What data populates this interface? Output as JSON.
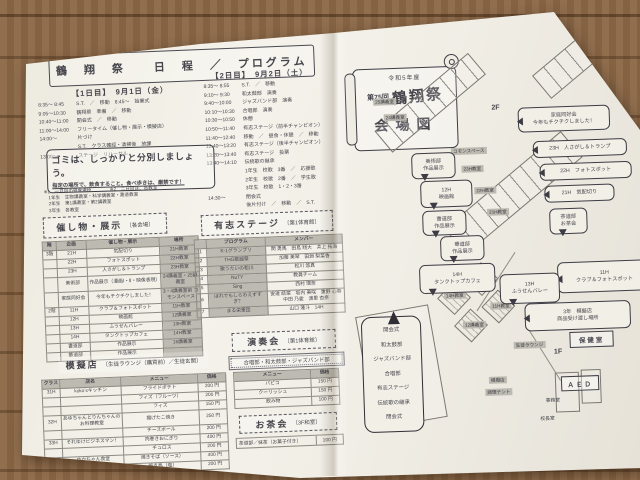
{
  "left_page": {
    "title": "鶴　翔　祭　　日　程　／　プログラム",
    "day1": {
      "heading": "【1日目】　9月1日（金）",
      "rows": [
        {
          "time": "8:35～ 8:45",
          "text": "S.T.　／　移動　8:45～　始業式"
        },
        {
          "time": "9:05～10:30",
          "text": "鶴翔祭　準備　／　移動"
        },
        {
          "time": "10:40～11:00",
          "text": "開会式　／　移動"
        },
        {
          "time": "11:00～14:00",
          "text": "フリータイム（催し物・展示・模擬店）"
        },
        {
          "time": "14:00～",
          "text": "片づけ"
        },
        {
          "time": "",
          "text": "S.T.　クラス確認・清掃後　放課"
        },
        {
          "time": "13:00～",
          "text": "ステージ　リハーサル"
        }
      ]
    },
    "day2": {
      "heading": "【2日目】　9月2日（土）",
      "rows": [
        {
          "time": "8:35～ 8:55",
          "text": "S.T.　／　移動"
        },
        {
          "time": "9:10～ 9:30",
          "text": "和太鼓部　演奏"
        },
        {
          "time": "9:40～10:00",
          "text": "ジャズバンド部　演奏"
        },
        {
          "time": "10:10～10:30",
          "text": "合唱部　演奏"
        },
        {
          "time": "10:30～10:50",
          "text": "休憩"
        },
        {
          "time": "10:50～11:40",
          "text": "有志ステージ（前半チャンピオン）"
        },
        {
          "time": "11:40～12:40",
          "text": "移動　／　昼食・休憩　／　移動"
        },
        {
          "time": "12:40～13:20",
          "text": "有志ステージ（後半チャンピオン）"
        },
        {
          "time": "13:20～13:40",
          "text": "有志ステージ　投票"
        },
        {
          "time": "13:40～14:10",
          "text": "伝統歌の継承"
        },
        {
          "time": "",
          "text": "1年生　校歌　3番　／　応援歌"
        },
        {
          "time": "",
          "text": "2年生　校歌　2番　／　学生歌"
        },
        {
          "time": "",
          "text": "3年生　校歌　1・2・3番"
        },
        {
          "time": "14:30～",
          "text": "閉会式"
        },
        {
          "time": "",
          "text": "後片付け　／　移動　／　S.T."
        }
      ]
    },
    "notice": {
      "line1": "ゴミは、しっかりと分別しましょう。",
      "line2": "指定の場所で、飲食すること。食べ歩きは、厳禁です！"
    },
    "footnotes": [
      "※1　一日目の昼食場所　　　　※2　二日目は、各教室",
      "　1年生　生物講義室・科学講義室・書道教室",
      "　2年生　第1講義室・第2講義室",
      "　3年生　各教室"
    ],
    "events": {
      "title": "催し物・展示",
      "venue": "〔各会場〕",
      "columns": [
        "階",
        "企画",
        "催し物・展示",
        "場所"
      ],
      "rows": [
        {
          "floor": "3階",
          "org": "21H",
          "name": "気配切り",
          "place": "21H教室"
        },
        {
          "floor": "",
          "org": "22H",
          "name": "フォトスポット",
          "place": "22H教室"
        },
        {
          "floor": "",
          "org": "23H",
          "name": "人さがし＆トランプ",
          "place": "23H教室"
        },
        {
          "floor": "",
          "org": "美術部",
          "name": "作品展示（漫画Ⅰ・Ⅱ・映像表現）",
          "place": "24講義室・25講義室"
        },
        {
          "floor": "",
          "org": "家庭同好会",
          "name": "今年もチクチクしました！",
          "place": "3・4講義室前 コモンスペース"
        },
        {
          "floor": "2階",
          "org": "11H",
          "name": "クラブ＆フォトスポット",
          "place": "11H教室"
        },
        {
          "floor": "",
          "org": "12H",
          "name": "映画館",
          "place": "12講義室"
        },
        {
          "floor": "",
          "org": "13H",
          "name": "ふうせんバレー",
          "place": "13H教室"
        },
        {
          "floor": "",
          "org": "14H",
          "name": "タンクトップカフェ",
          "place": "14H教室"
        },
        {
          "floor": "",
          "org": "書道部",
          "name": "作品展示",
          "place": "15講義室"
        },
        {
          "floor": "",
          "org": "華道部",
          "name": "作品展示",
          "place": ""
        }
      ]
    },
    "stage": {
      "title": "有志ステージ",
      "venue": "〔第1体育館〕",
      "columns": [
        "プログラム",
        "メンバー"
      ],
      "rows": [
        {
          "no": "1",
          "program": "K-1グランプリ",
          "members": "関 勇馬　田島 翔大　井上 拓海"
        },
        {
          "no": "2",
          "program": "THG歌謡祭",
          "members": "加藤 美琴　田淵 梨菜香"
        },
        {
          "no": "3",
          "program": "歌うたいの松川",
          "members": "松川 悠真"
        },
        {
          "no": "4",
          "program": "NuTY",
          "members": "教員チーム"
        },
        {
          "no": "5",
          "program": "Sing",
          "members": "西村 環奈"
        },
        {
          "no": "6",
          "program": "ほれでもしらわえずすぎ？",
          "members": "安達 結菜　坂内 美咲　重野 心春　中田 乃愛　渡里 杏奈"
        },
        {
          "no": "7",
          "program": "まる栄軍団",
          "members": "山口 蓮斗　14H"
        }
      ]
    },
    "concert": {
      "title": "演奏会",
      "venue": "〔第1体育館〕",
      "performers": "合唱部・和太鼓部・ジャズバンド部"
    },
    "shops": {
      "title": "模擬店",
      "venue": "〔生徒ラウンジ（購買前）／生徒玄関〕",
      "columns": [
        "クラス",
        "店名",
        "メニュー",
        "価格"
      ],
      "side_columns": [
        "メニュー",
        "価格"
      ],
      "rows": [
        {
          "cls": "31H",
          "shop": "koko’sキッチン",
          "item": "フライドポテト",
          "price": "200 円"
        },
        {
          "cls": "",
          "shop": "",
          "item": "フィズ（フルーツ）",
          "price": "200 円"
        },
        {
          "cls": "",
          "shop": "",
          "item": "フィズ",
          "price": "150 円"
        },
        {
          "cls": "32H",
          "shop": "あゆちゃんとりんちゃんの お料理教室",
          "item": "揚げたこ焼き",
          "price": "250 円"
        },
        {
          "cls": "",
          "shop": "",
          "item": "チーズボール",
          "price": "200 円"
        },
        {
          "cls": "33H",
          "shop": "それゆけビジネスマン！",
          "item": "肉巻きおにぎり",
          "price": "400 円"
        },
        {
          "cls": "",
          "shop": "",
          "item": "チュロス",
          "price": "200 円"
        },
        {
          "cls": "34H",
          "shop": "ゆかちゃん食堂",
          "item": "焼きそば（ソース）",
          "price": "400 円"
        },
        {
          "cls": "",
          "shop": "",
          "item": "焼き鳥（塩）",
          "price": "200 円"
        }
      ],
      "side_rows": [
        {
          "item": "パピコ",
          "price": "150 円"
        },
        {
          "item": "クーリッシュ",
          "price": "150 円"
        },
        {
          "item": "飲み物",
          "price": "100 円"
        }
      ]
    },
    "tea": {
      "title": "お茶会",
      "venue": "〔3F和室〕",
      "item": "茶道部／抹茶（お菓子付き）",
      "price": "100 円"
    }
  },
  "right_page": {
    "banner": {
      "year": "令和5年度",
      "edition": "第75回",
      "name": "鶴翔祭",
      "subtitle": "会場図"
    },
    "gym_lines": [
      "開会式",
      "和太鼓部",
      "ジャズバンド部",
      "合唱部",
      "有志ステージ",
      "伝統歌の継承",
      "閉会式"
    ],
    "callouts": [
      {
        "l1": "美術部",
        "l2": "作品展示"
      },
      {
        "l1": "12H",
        "l2": "映画館"
      },
      {
        "l1": "書道部",
        "l2": "作品展示"
      },
      {
        "l1": "華道部",
        "l2": "作品展示"
      },
      {
        "l1": "14H",
        "l2": "タンクトップカフェ"
      },
      {
        "l1": "家庭同好会",
        "l2": "今年もチクチクしました！"
      },
      {
        "l1": "23H　人さがし＆トランプ"
      },
      {
        "l1": "22H　フォトスポット"
      },
      {
        "l1": "21H　気配切り"
      },
      {
        "l1": "茶道部",
        "l2": "お茶会"
      },
      {
        "l1": "11H",
        "l2": "クラブ＆フォトスポット"
      },
      {
        "l1": "13H",
        "l2": "ふうせんバレー"
      },
      {
        "l1": "3年　模擬店",
        "l2": "商品受け渡し場所"
      }
    ],
    "rooms": [
      "25講義室",
      "24講義室",
      "コモンスペース",
      "23H教室",
      "22H教室",
      "21H教室",
      "15講義室",
      "14H教室",
      "13H教室",
      "12講義室",
      "11H教室"
    ],
    "labels": {
      "hoken": "保健室",
      "aed": "ＡＥＤ",
      "f1": "1F",
      "f2": "2F",
      "mogiten": "模擬店",
      "chouri": "調理テント",
      "lounge": "生徒ラウンジ",
      "jimu": "事務室",
      "kocho": "校長室"
    }
  }
}
